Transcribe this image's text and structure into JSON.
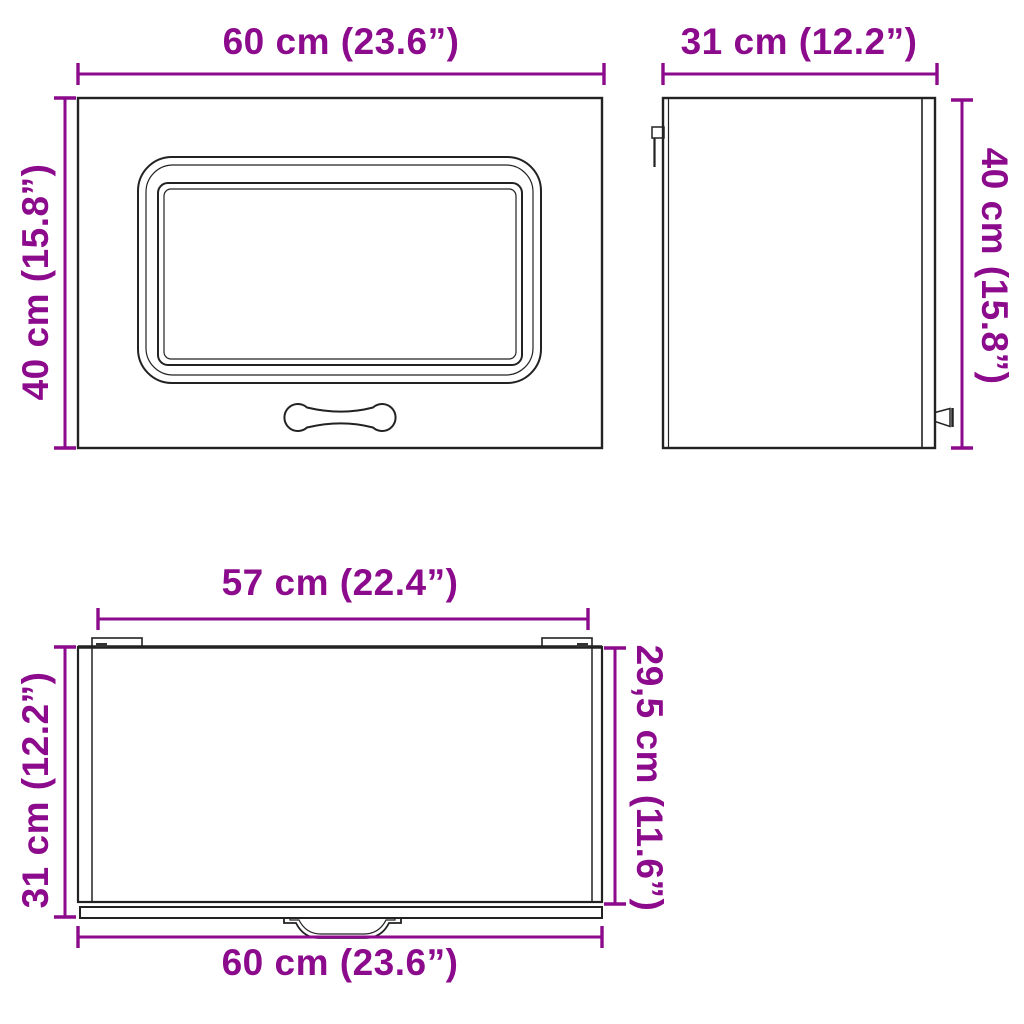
{
  "diagram": {
    "accent_color": "#8C0A8C",
    "line_color": "#222222",
    "labels": {
      "front_width": "60 cm (23.6”)",
      "front_height": "40 cm (15.8”)",
      "side_depth": "31 cm (12.2”)",
      "side_height": "40 cm (15.8”)",
      "top_inner_width": "57 cm (22.4”)",
      "top_depth": "31 cm (12.2”)",
      "top_inner_depth": "29,5 cm (11.6”)",
      "bottom_width": "60 cm (23.6”)"
    }
  }
}
